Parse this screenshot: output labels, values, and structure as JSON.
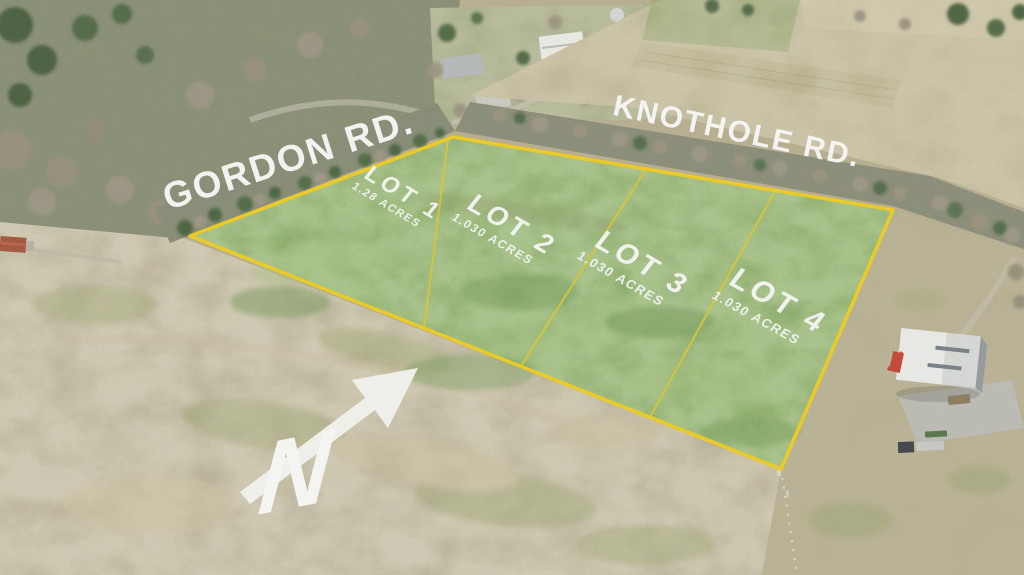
{
  "roads": {
    "gordon": "GORDON RD.",
    "knothole": "KNOTHOLE RD."
  },
  "lots": [
    {
      "name": "LOT 1",
      "acres": "1.28 ACRES"
    },
    {
      "name": "LOT 2",
      "acres": "1.030 ACRES"
    },
    {
      "name": "LOT 3",
      "acres": "1.030 ACRES"
    },
    {
      "name": "LOT 4",
      "acres": "1.030 ACRES"
    }
  ],
  "compass": {
    "label": "N",
    "icon": "north-arrow"
  },
  "colors": {
    "boundary": "#f2cd11",
    "divider": "#d6c62c",
    "label": "#ffffff",
    "parcel": "#79a351"
  }
}
